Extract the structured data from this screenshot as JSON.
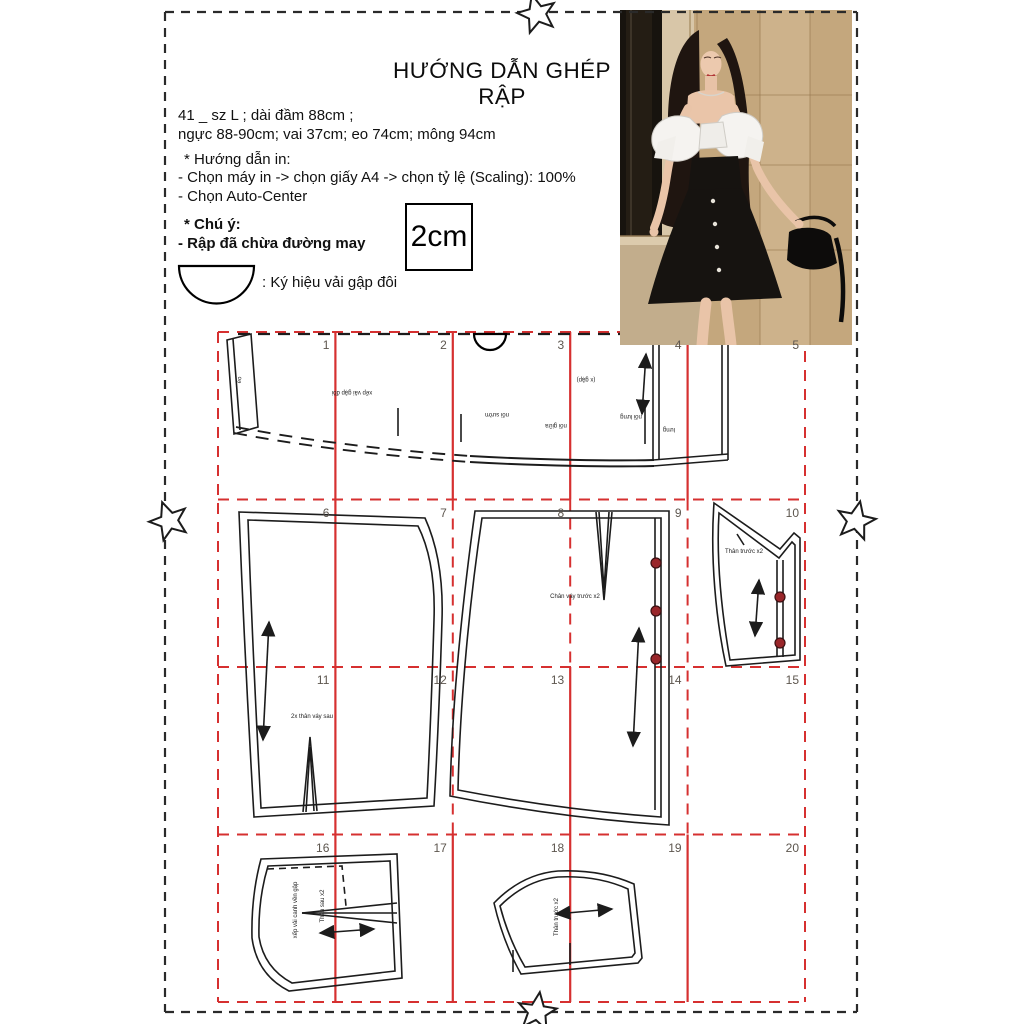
{
  "header": {
    "title": "HƯỚNG DẪN GHÉP RẬP",
    "size_line1": "41 _ sz L ; dài đầm 88cm ;",
    "size_line2": "ngực 88-90cm; vai 37cm; eo 74cm; mông 94cm",
    "print_header": "* Hướng dẫn in:",
    "print_step1": "- Chọn máy in -> chọn giấy A4 -> chọn tỷ lệ (Scaling): 100%",
    "print_step2": "- Chọn Auto-Center",
    "note_header": "* Chú ý:",
    "note_line": "- Rập đã chừa đường may",
    "scale_box_label": "2cm",
    "fold_symbol_label": ": Ký hiệu vải gập đôi"
  },
  "grid": {
    "numbers": [
      "1",
      "2",
      "3",
      "4",
      "5",
      "6",
      "7",
      "8",
      "9",
      "10",
      "11",
      "12",
      "13",
      "14",
      "15",
      "16",
      "17",
      "18",
      "19",
      "20"
    ]
  },
  "pieces": {
    "labels": [
      {
        "text": "eo",
        "x": 240,
        "y": 380,
        "rot": -83
      },
      {
        "text": "xếp vải gập đôi",
        "x": 352,
        "y": 392,
        "rot": 180
      },
      {
        "text": "(x gập)",
        "x": 586,
        "y": 379,
        "rot": 180
      },
      {
        "text": "nối sườn",
        "x": 497,
        "y": 414,
        "rot": 180
      },
      {
        "text": "nối giữa",
        "x": 556,
        "y": 425,
        "rot": 180
      },
      {
        "text": "nối lưng",
        "x": 631,
        "y": 416,
        "rot": 180
      },
      {
        "text": "lưng",
        "x": 669,
        "y": 429,
        "rot": 180
      },
      {
        "text": "2x thân váy sau",
        "x": 312,
        "y": 717,
        "rot": 0
      },
      {
        "text": "Chân váy trước x2",
        "x": 575,
        "y": 597,
        "rot": 0
      },
      {
        "text": "Thân trước x2",
        "x": 744,
        "y": 552,
        "rot": 0
      },
      {
        "text": "Thân sau x2",
        "x": 323,
        "y": 906,
        "rot": -90
      },
      {
        "text": "xếp vải canh vền gập",
        "x": 296,
        "y": 910,
        "rot": -90
      },
      {
        "text": "Thân trước x2",
        "x": 557,
        "y": 917,
        "rot": -90
      }
    ],
    "buttons": {
      "positions": [
        [
          656,
          563
        ],
        [
          656,
          611
        ],
        [
          656,
          659
        ],
        [
          780,
          597
        ],
        [
          780,
          643
        ]
      ]
    }
  },
  "colors": {
    "grid_red": "#d63030",
    "pattern_black": "#1c1c1c",
    "border_black": "#2a2a2a",
    "button_red": "#99262a",
    "button_rim": "#3c1012"
  }
}
